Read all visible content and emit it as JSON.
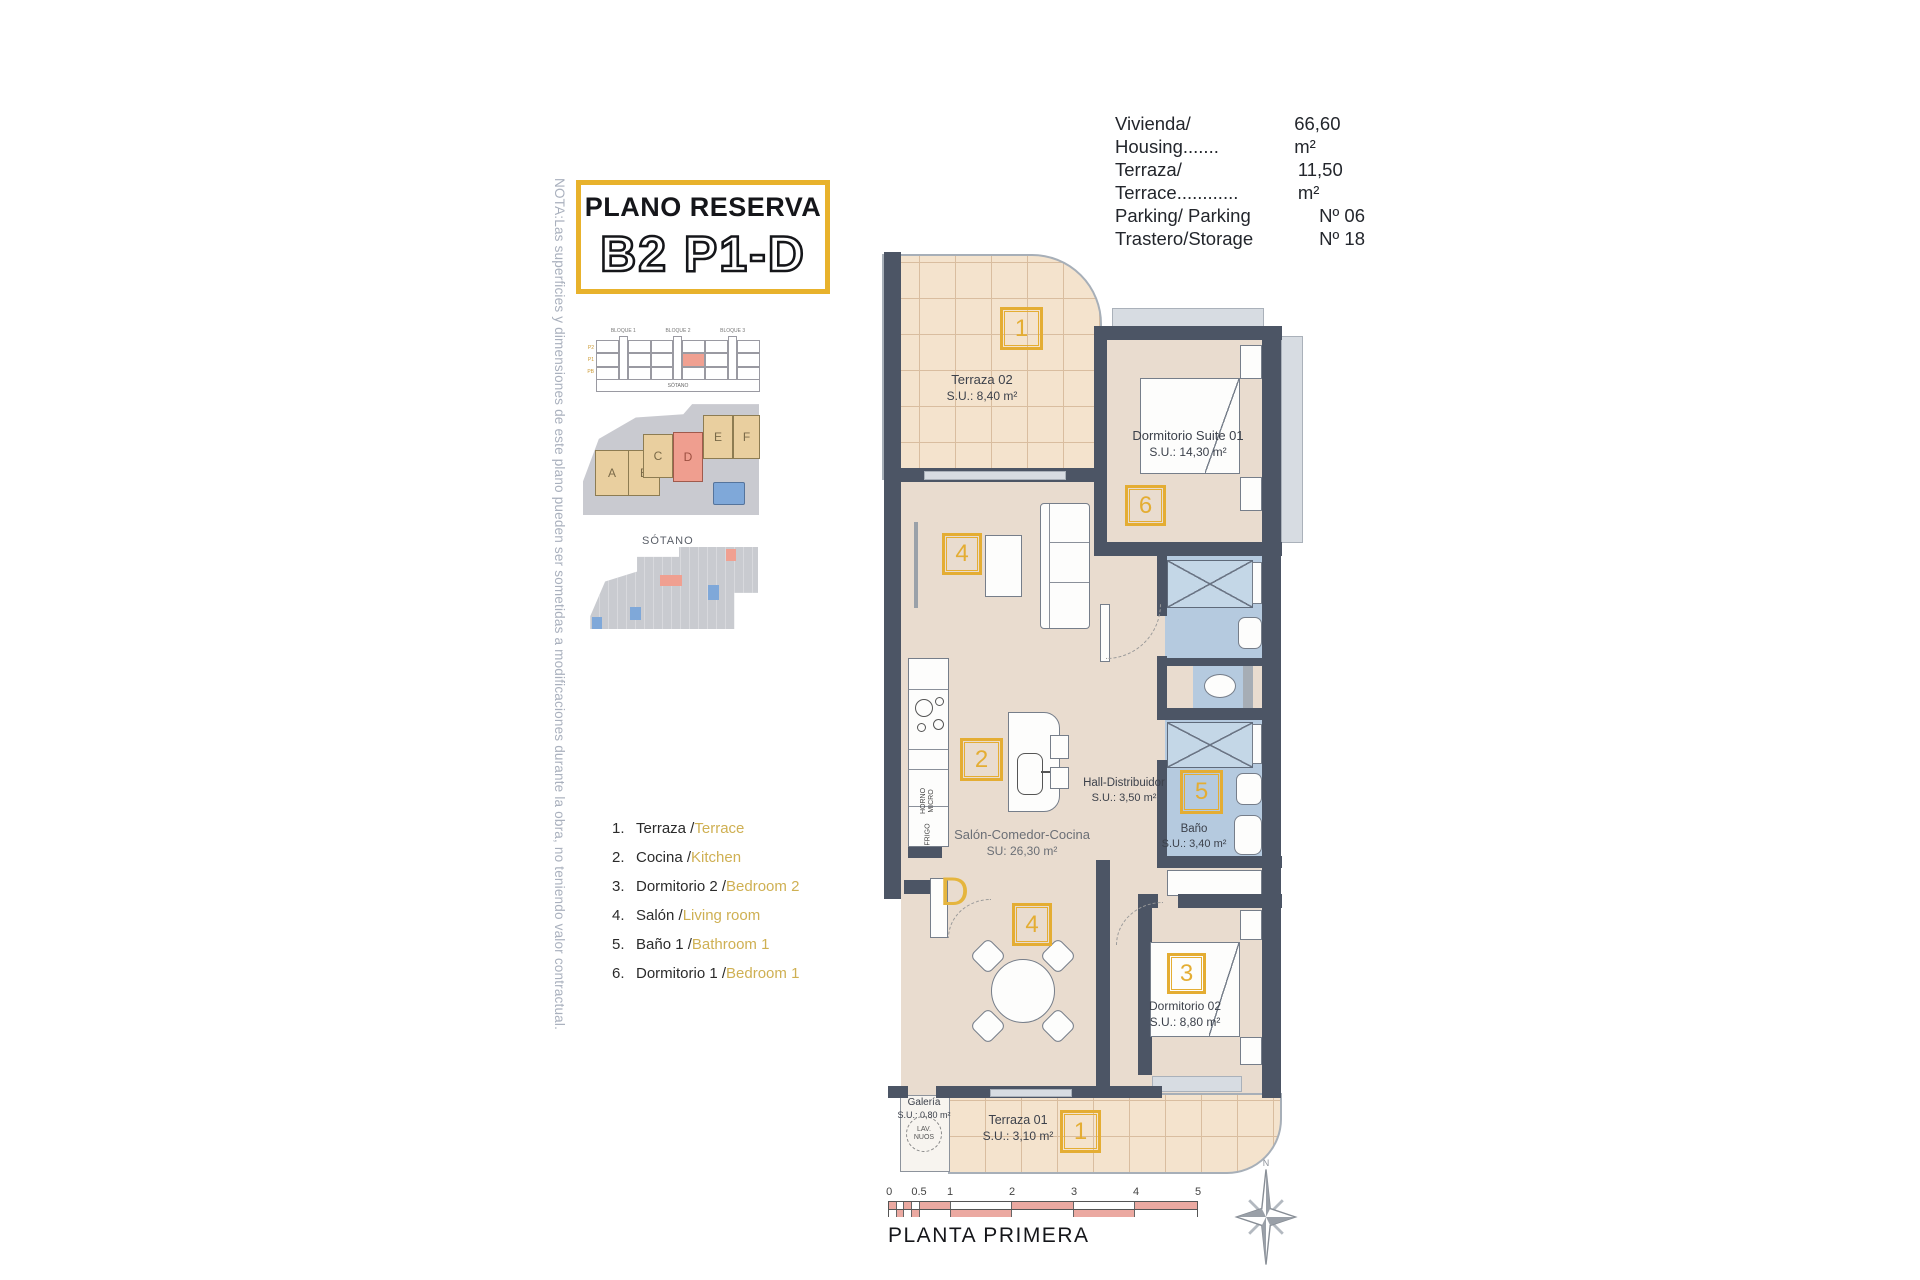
{
  "note": {
    "text": "NOTA:Las superficies y dimensiones de este plano pueden ser sometidas a modificaciones durante la obra, no teniendo valor contractual."
  },
  "title_block": {
    "subtitle": "PLANO RESERVA",
    "title": "B2 P1-D"
  },
  "info": {
    "rows": [
      {
        "label": "Vivienda/ Housing.......",
        "value": "66,60 m²"
      },
      {
        "label": "Terraza/ Terrace............",
        "value": "11,50 m²"
      },
      {
        "label": "Parking/ Parking",
        "value": "Nº 06"
      },
      {
        "label": "Trastero/Storage",
        "value": "Nº 18"
      }
    ]
  },
  "legend": {
    "items": [
      {
        "num": "1.",
        "es": "Terraza / ",
        "en": "Terrace"
      },
      {
        "num": "2.",
        "es": "Cocina / ",
        "en": "Kitchen"
      },
      {
        "num": "3.",
        "es": "Dormitorio 2 / ",
        "en": "Bedroom 2"
      },
      {
        "num": "4.",
        "es": "Salón / ",
        "en": "Living room"
      },
      {
        "num": "5.",
        "es": "Baño 1 / ",
        "en": "Bathroom 1"
      },
      {
        "num": "6.",
        "es": "Dormitorio 1 /",
        "en": "Bedroom 1"
      }
    ]
  },
  "mini_elevation": {
    "blocks": [
      "BLOQUE 1",
      "BLOQUE 2",
      "BLOQUE 3"
    ],
    "floors": [
      "P2",
      "P1",
      "PB"
    ],
    "units": [
      "viv.A",
      "viv.B",
      "viv.C",
      "viv.D",
      "viv.E",
      "viv.F"
    ],
    "basement": "SÓTANO"
  },
  "site_plan": {
    "units": [
      "A",
      "B",
      "C",
      "D",
      "E",
      "F"
    ],
    "highlighted": "D"
  },
  "basement_plan": {
    "label": "SÓTANO"
  },
  "floor_plan": {
    "rooms": [
      {
        "name": "Terraza 02",
        "area": "S.U.: 8,40 m²",
        "tag": "1"
      },
      {
        "name": "Dormitorio Suite 01",
        "area": "S.U.: 14,30 m²",
        "tag": "6"
      },
      {
        "name": "Hall-Distribuidor",
        "area": "S.U.: 3,50 m²"
      },
      {
        "name": "Salón-Comedor-Cocina",
        "area": "SU: 26,30 m²",
        "tag_living": "4",
        "tag_kitchen": "2",
        "tag_dining": "4"
      },
      {
        "name": "Baño",
        "area": "S.U.: 3,40 m²",
        "tag": "5"
      },
      {
        "name": "Dormitorio 02",
        "area": "S.U.: 8,80 m²",
        "tag": "3"
      },
      {
        "name": "Galería",
        "area": "S.U.: 0,80 m²"
      },
      {
        "name": "Terraza 01",
        "area": "S.U.: 3,10 m²",
        "tag": "1"
      }
    ],
    "door_label": "D",
    "appliances": {
      "horno": "HORNO",
      "micro": "MICRO",
      "frigo": "FRIGO",
      "lav1": "LAV.",
      "lav2": "NUOS"
    }
  },
  "footer": {
    "scale_ticks": [
      "0",
      "0.5",
      "1",
      "2",
      "3",
      "4",
      "5"
    ],
    "caption": "PLANTA PRIMERA",
    "compass_n": "N"
  },
  "colors": {
    "accent_yellow": "#E4AD33",
    "wall": "#4C5565",
    "bath_blue": "#B5CADF",
    "floor_beige": "#E9DCCF",
    "terrace_tile": "#F4E3CD",
    "highlight_red": "#EF9E8F",
    "scale_red": "#EBA9A1",
    "block_tan": "#E9CF9F"
  }
}
